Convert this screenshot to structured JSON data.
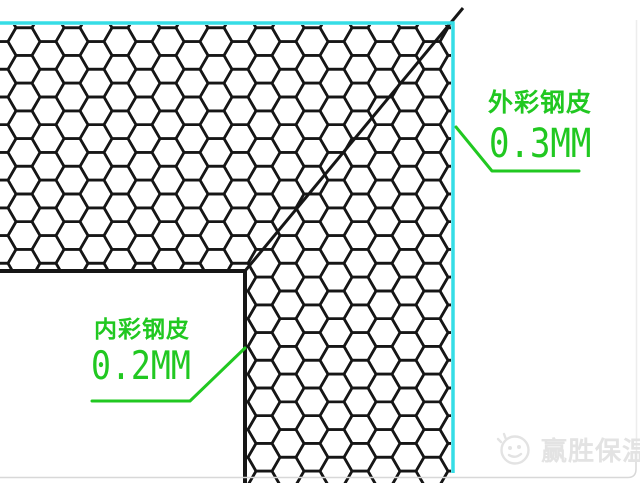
{
  "drawing": {
    "outer_label": {
      "name": "外彩钢皮",
      "thickness": "0.3MM"
    },
    "inner_label": {
      "name": "内彩钢皮",
      "thickness": "0.2MM"
    }
  },
  "watermark": {
    "text": "赢胜保温"
  },
  "icons": {
    "watermark_logo": "smiley-face-logo-icon",
    "hatch": "honeycomb-pattern"
  },
  "colors": {
    "annotation_green": "#21c821",
    "panel_cyan": "#36dde6",
    "hatch_black": "#161616",
    "watermark_gray": "#e3e3e3",
    "page_border_gray": "#d8d8d8"
  }
}
